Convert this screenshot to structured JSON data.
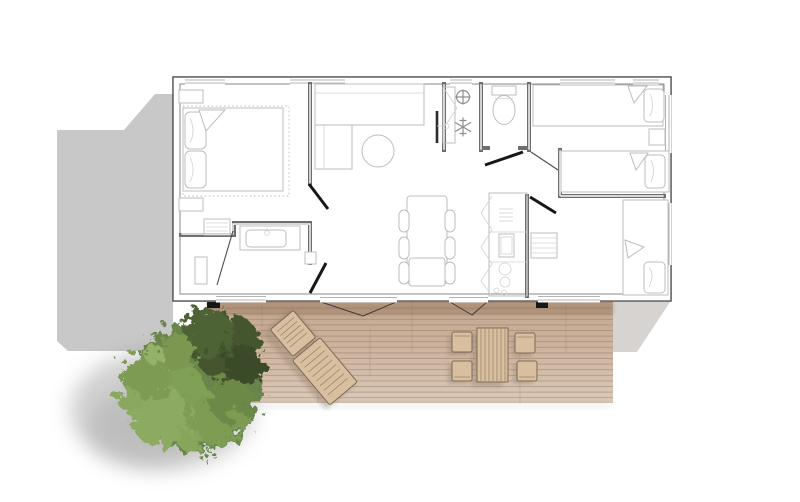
{
  "scene_type": "floor-plan-top-view",
  "colors": {
    "bg": "#ffffff",
    "shadow_left": "#c8c8c8",
    "shadow_right": "#d6d3d0",
    "wall_dark": "#4f4f4f",
    "wall_mid": "#8a8a8a",
    "wall_fill": "#e2e2e2",
    "partition": "#6e6e6e",
    "furniture_line": "#bdbdbd",
    "furniture_soft": "#d2d2d2",
    "window_line": "#9b9b9b",
    "door_black": "#171717",
    "door_thin": "#4d4d4d",
    "icon_gray": "#8f8f8f",
    "deck_top": "#c2a68f",
    "deck_mid": "#cfb7a3",
    "deck_bottom": "#dbc9b7",
    "deck_shade_band": "#8f6f57",
    "plank_line": "#7d5f4b",
    "wood_furniture": "#d7bf9f",
    "wood_dark": "#7e6b52",
    "cast_shadow": "#8b7a67",
    "tree_base": "#69854b",
    "tree_dark": "#44572f",
    "tree_darker": "#3a4c2a",
    "tree_light": "#8cab60",
    "tree_lighter": "#95b269",
    "tree_shadow": "#8a8a8a"
  },
  "building": {
    "rooms": [
      "master-bedroom",
      "bathroom",
      "living-area",
      "utility-closet",
      "wc",
      "kitchen",
      "twin-bedroom",
      "rear-bedroom"
    ],
    "furniture": [
      "double-bed",
      "nightstands",
      "dresser",
      "vanity-sink",
      "shower-fixture",
      "sofa-l-shape",
      "round-coffee-table",
      "tv",
      "toilet",
      "kitchen-counter",
      "sink",
      "cooktop-burners",
      "dining-table",
      "dining-chairs",
      "single-beds",
      "shelving"
    ],
    "single_bed_count": 4,
    "door_leaf_count": 6
  },
  "icons": [
    {
      "name": "freezer-snowflake-icon"
    },
    {
      "name": "boiler-cross-icon"
    }
  ],
  "deck": {
    "furniture": [
      "sun-lounger",
      "outdoor-table",
      "outdoor-chairs"
    ],
    "outdoor_chair_count": 4
  },
  "landscape": [
    "tree",
    "tree-shadow",
    "ground-shadow-left",
    "ground-shadow-right"
  ]
}
